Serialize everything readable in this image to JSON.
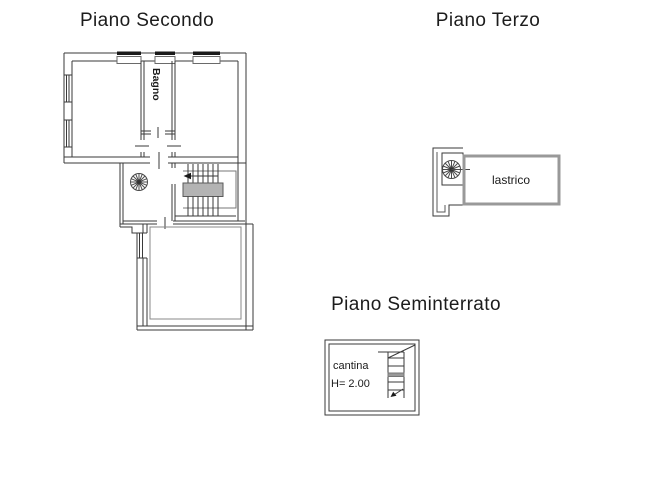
{
  "floors": {
    "secondo": {
      "title": "Piano Secondo",
      "rooms": {
        "bagno": "Bagno"
      }
    },
    "terzo": {
      "title": "Piano Terzo",
      "rooms": {
        "lastrico": "lastrico"
      }
    },
    "seminterrato": {
      "title": "Piano Seminterrato",
      "rooms": {
        "cantina": "cantina",
        "cantina_height": "H= 2.00"
      }
    }
  },
  "colors": {
    "wall_line": "#3a3a3a",
    "thin_outline": "#888888",
    "stair_landing_fill": "#b3b3b3",
    "lastrico_border": "#999999",
    "window_bar": "#1a1a1a",
    "background": "#ffffff"
  }
}
